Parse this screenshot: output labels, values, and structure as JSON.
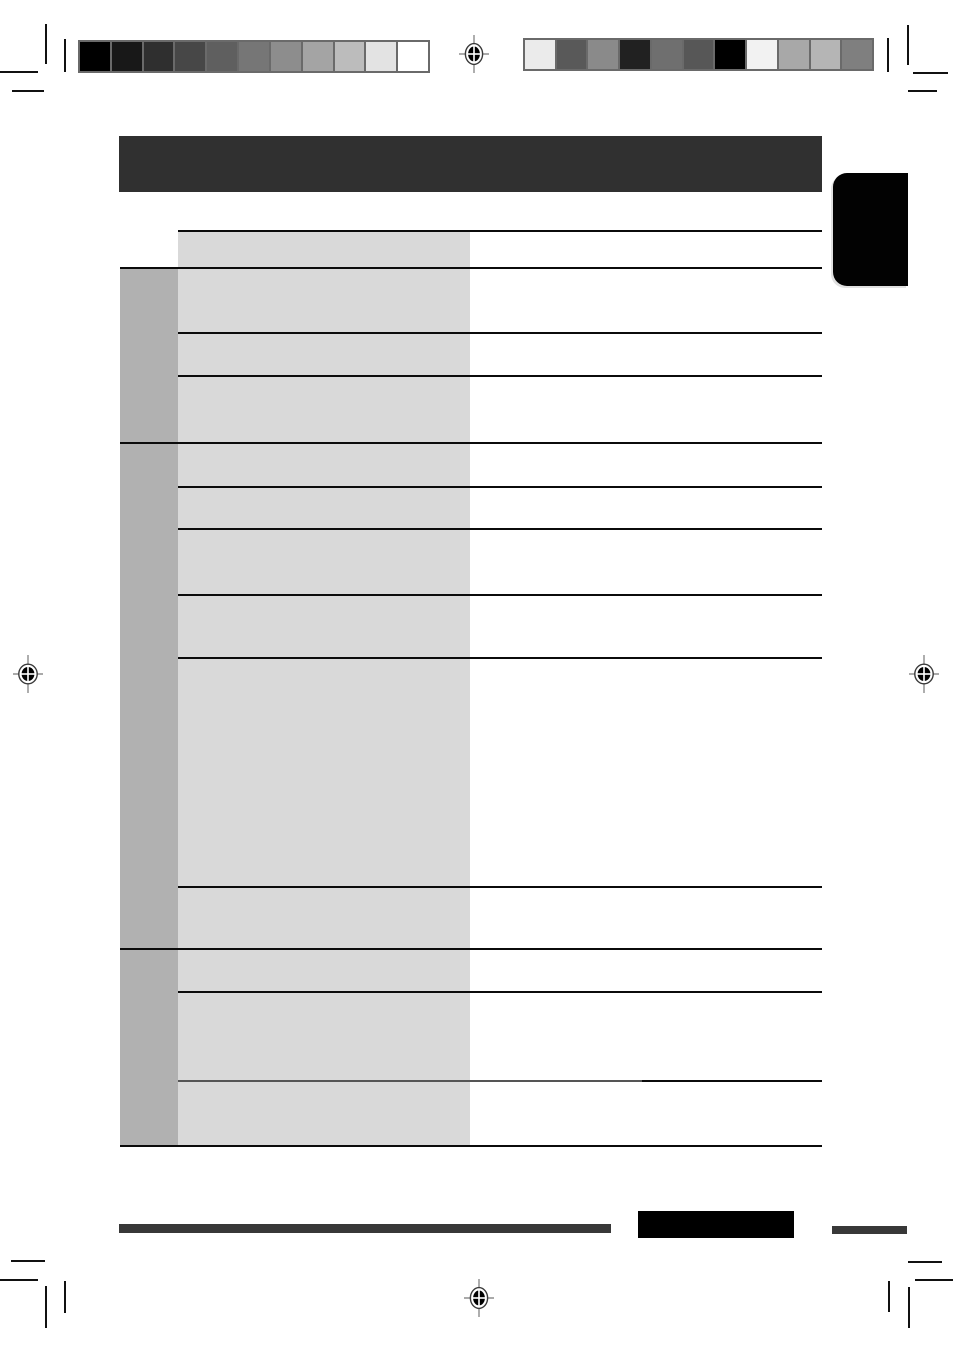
{
  "page": {
    "width": 953,
    "height": 1352,
    "kind": "blank-scanned-manual-proof-page",
    "visible_text": ""
  },
  "colors": {
    "page_bg": "#ffffff",
    "header_bar": "#303030",
    "side_tab": "#020202",
    "footer_bar": "#383838",
    "footer_box": "#000000",
    "table_light_column": "#d9d9d9",
    "table_dark_column": "#b1b1b1",
    "rule_line": "#0b0b0b",
    "rule_line_soft": "#555555",
    "calibration_border": "#6a6a6a"
  },
  "calibration": {
    "left_bar_shades": [
      "#000000",
      "#181818",
      "#2f2f2f",
      "#474747",
      "#5f5f5f",
      "#767676",
      "#8d8d8d",
      "#a4a4a4",
      "#bcbcbc",
      "#e3e3e3",
      "#ffffff"
    ],
    "right_bar_shades": [
      "#ebebeb",
      "#595959",
      "#8a8a8a",
      "#212121",
      "#6f6f6f",
      "#575757",
      "#000000",
      "#f2f2f2",
      "#a8a8a8",
      "#b5b5b5",
      "#7f7f7f"
    ]
  },
  "table": {
    "x_left": 120,
    "x_col2": 178,
    "x_col2_end": 470,
    "x_right": 822,
    "top": 231,
    "bottom": 1146,
    "section_lines": [
      268,
      443,
      949
    ],
    "row_lines": [
      333,
      376,
      487,
      529,
      595,
      658,
      887,
      992
    ],
    "split_line": {
      "y": 1081,
      "x_break": 642
    },
    "cells_text": []
  }
}
